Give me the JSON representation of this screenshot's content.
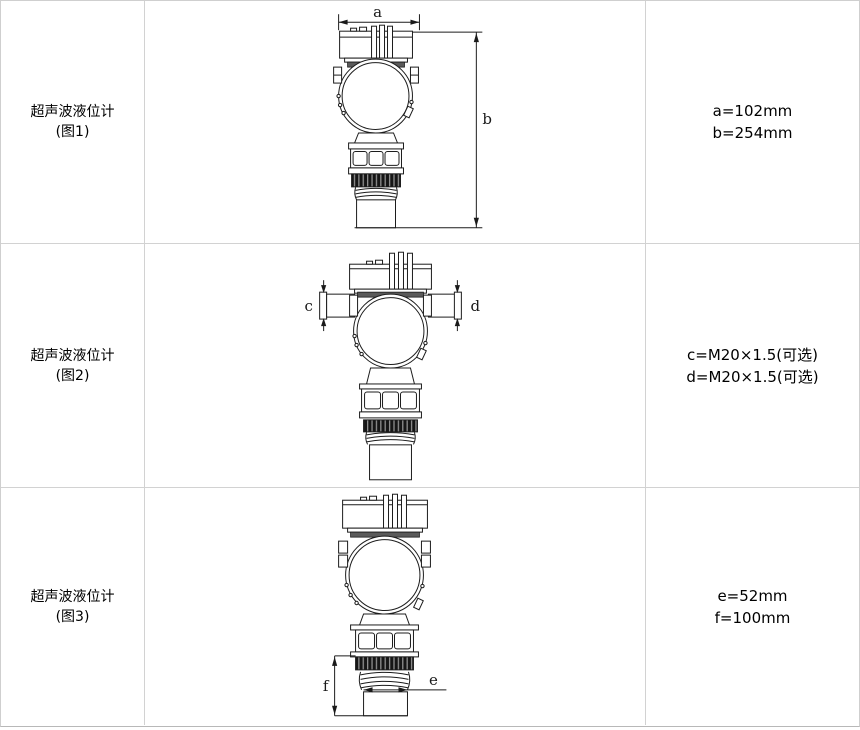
{
  "table": {
    "rows": [
      {
        "label": "超声波液位计",
        "figure": "(图1)",
        "dim_line1": "a=102mm",
        "dim_line2": "b=254mm",
        "marker_primary": "a",
        "marker_secondary": "b"
      },
      {
        "label": "超声波液位计",
        "figure": "(图2)",
        "dim_line1": "c=M20×1.5(可选)",
        "dim_line2": "d=M20×1.5(可选)",
        "marker_primary": "c",
        "marker_secondary": "d"
      },
      {
        "label": "超声波液位计",
        "figure": "(图3)",
        "dim_line1": "e=52mm",
        "dim_line2": "f=100mm",
        "marker_primary": "e",
        "marker_secondary": "f"
      }
    ],
    "colors": {
      "border": "#d2d2d2",
      "outer_border": "#cfcfcf",
      "line": "#1c1c1c",
      "knurl_dark": "#161616",
      "background": "#ffffff"
    }
  }
}
